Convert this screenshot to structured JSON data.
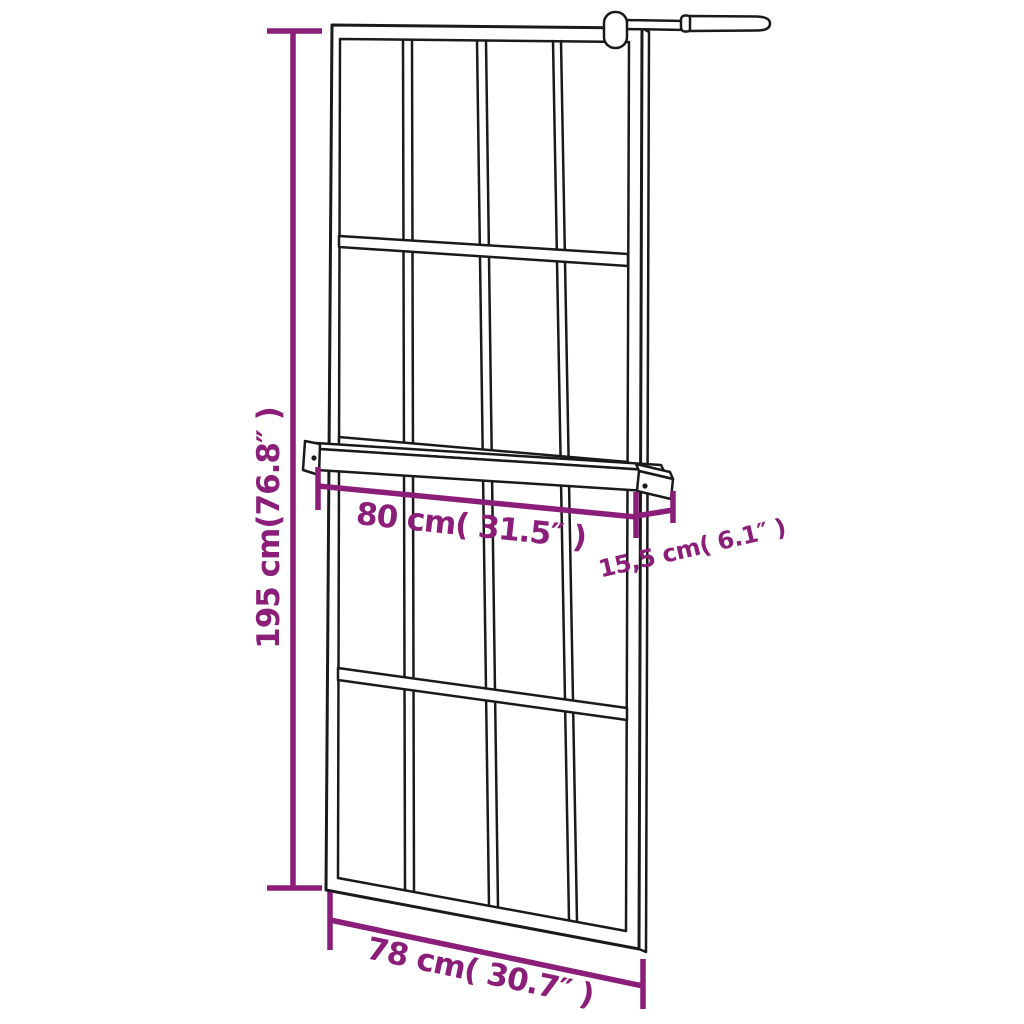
{
  "title": "Walk-in shower wall with shelf — dimension diagram",
  "colors": {
    "background": "#ffffff",
    "line": "#1a1a1a",
    "dimension": "#8B1E78"
  },
  "dimensions": {
    "height": {
      "label": "195 cm(76.8″ )"
    },
    "shelf_width": {
      "label": "80 cm( 31.5″ )"
    },
    "shelf_depth": {
      "label": "15,5 cm( 6.1″ )"
    },
    "base_width": {
      "label": "78 cm( 30.7″ )"
    }
  }
}
